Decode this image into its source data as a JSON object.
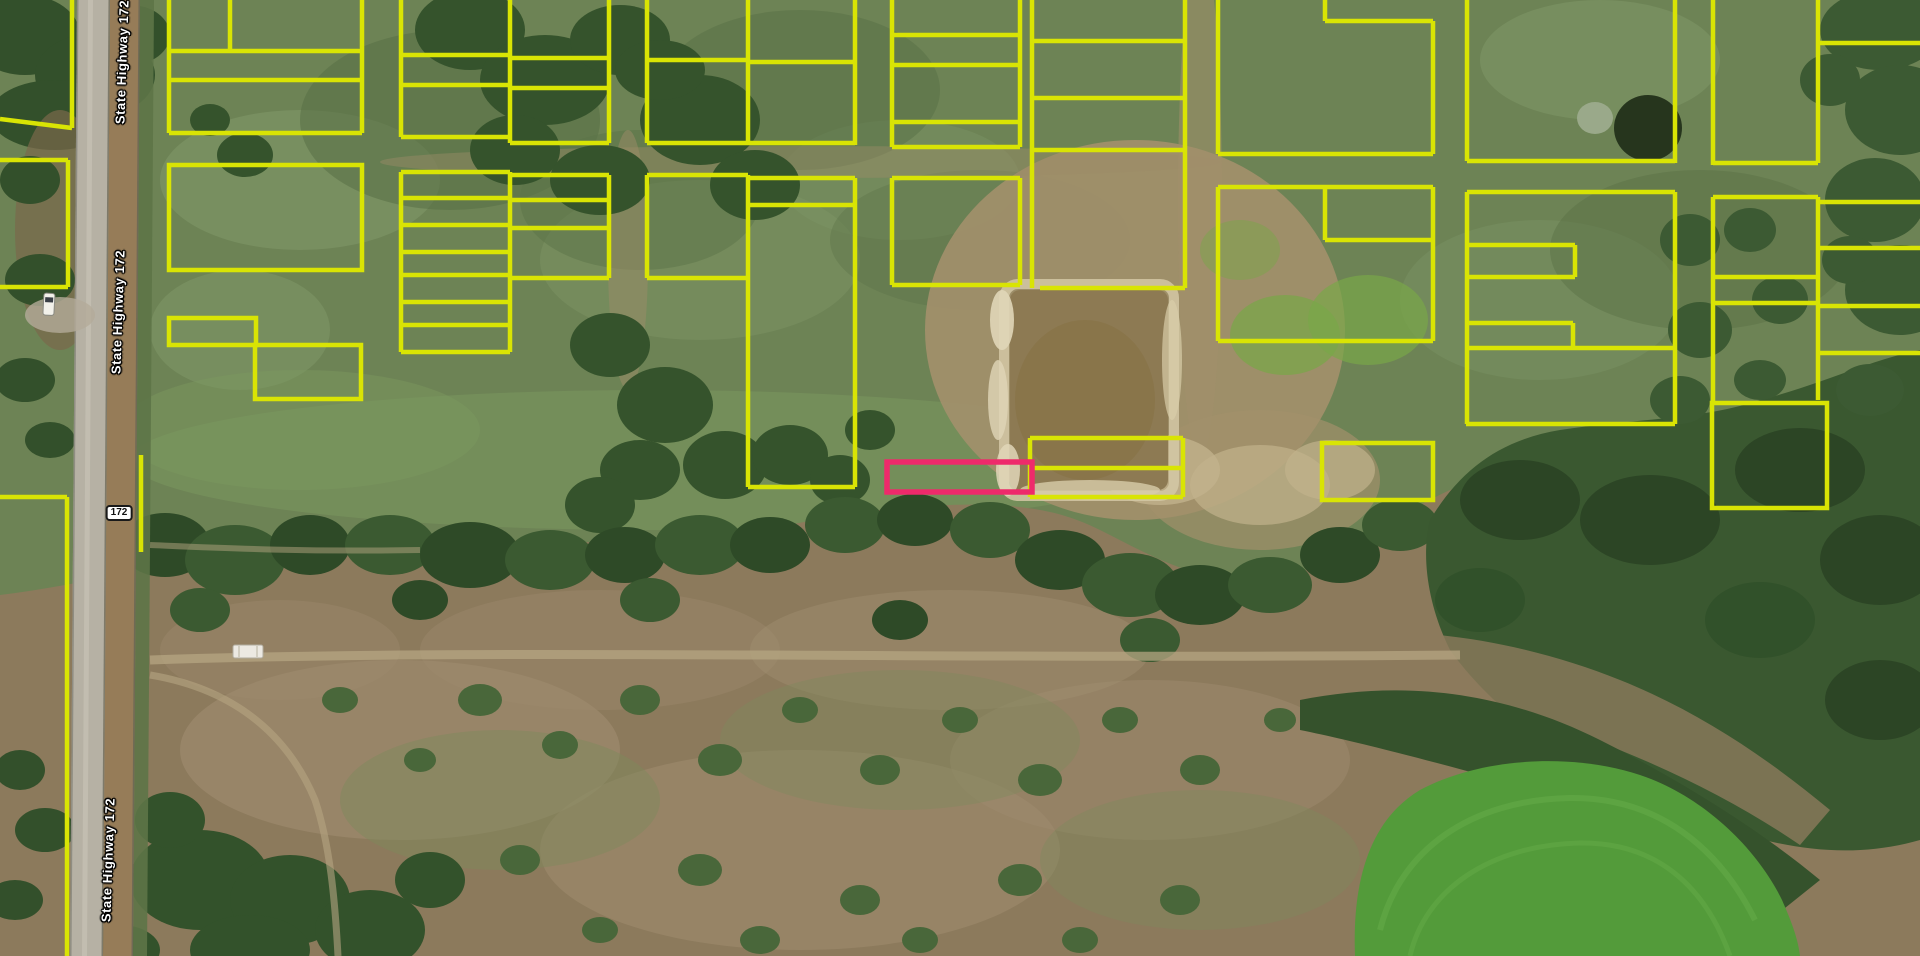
{
  "map": {
    "view": "aerial-imagery-with-parcel-overlay",
    "colors": {
      "parcel_line": "#d9e404",
      "selected_parcel": "#ee2a6b",
      "label_text": "#ffffff",
      "label_outline": "#000000",
      "shield_bg": "#ffffff",
      "shield_border": "#1a1a1a"
    },
    "road_labels": [
      {
        "text": "State Highway 172",
        "x": 122,
        "y": 62,
        "rotation": -88
      },
      {
        "text": "State Highway 172",
        "x": 118,
        "y": 312,
        "rotation": -88
      },
      {
        "text": "State Highway 172",
        "x": 108,
        "y": 860,
        "rotation": -88
      }
    ],
    "shield": {
      "text": "172",
      "x": 119,
      "y": 513
    },
    "selected_parcel": {
      "x": 887,
      "y": 462,
      "w": 145,
      "h": 30
    },
    "parcel_rects": [
      [
        169,
        165,
        193,
        105
      ],
      [
        169,
        318,
        87,
        27
      ],
      [
        255,
        345,
        106,
        54
      ],
      [
        1712,
        403,
        115,
        105
      ],
      [
        1322,
        443,
        111,
        57
      ]
    ],
    "parcel_segments": [
      [
        72,
        0,
        72,
        128
      ],
      [
        72,
        128,
        0,
        119
      ],
      [
        0,
        160,
        68,
        160
      ],
      [
        68,
        160,
        68,
        287
      ],
      [
        68,
        287,
        0,
        287
      ],
      [
        0,
        497,
        67,
        497
      ],
      [
        67,
        497,
        67,
        956
      ],
      [
        169,
        0,
        169,
        133
      ],
      [
        362,
        0,
        362,
        133
      ],
      [
        169,
        51,
        362,
        51
      ],
      [
        169,
        80,
        362,
        80
      ],
      [
        169,
        133,
        362,
        133
      ],
      [
        230,
        0,
        230,
        51
      ],
      [
        141,
        455,
        141,
        552
      ],
      [
        401,
        0,
        401,
        137
      ],
      [
        510,
        0,
        510,
        143
      ],
      [
        609,
        0,
        609,
        143
      ],
      [
        401,
        55,
        510,
        55
      ],
      [
        510,
        58,
        609,
        58
      ],
      [
        401,
        85,
        510,
        85
      ],
      [
        510,
        88,
        609,
        88
      ],
      [
        401,
        137,
        510,
        137
      ],
      [
        510,
        143,
        609,
        143
      ],
      [
        401,
        172,
        401,
        352
      ],
      [
        510,
        172,
        510,
        352
      ],
      [
        609,
        175,
        609,
        278
      ],
      [
        401,
        172,
        510,
        172
      ],
      [
        510,
        175,
        609,
        175
      ],
      [
        401,
        198,
        510,
        198
      ],
      [
        510,
        200,
        609,
        200
      ],
      [
        401,
        225,
        510,
        225
      ],
      [
        510,
        228,
        609,
        228
      ],
      [
        401,
        252,
        510,
        252
      ],
      [
        401,
        275,
        510,
        275
      ],
      [
        510,
        278,
        609,
        278
      ],
      [
        401,
        302,
        510,
        302
      ],
      [
        401,
        325,
        510,
        325
      ],
      [
        401,
        352,
        510,
        352
      ],
      [
        647,
        0,
        647,
        143
      ],
      [
        748,
        0,
        748,
        143
      ],
      [
        855,
        0,
        855,
        145
      ],
      [
        647,
        60,
        748,
        60
      ],
      [
        748,
        62,
        855,
        62
      ],
      [
        647,
        143,
        855,
        143
      ],
      [
        647,
        175,
        647,
        278
      ],
      [
        748,
        175,
        748,
        487
      ],
      [
        855,
        178,
        855,
        487
      ],
      [
        647,
        175,
        748,
        175
      ],
      [
        748,
        178,
        855,
        178
      ],
      [
        748,
        205,
        855,
        205
      ],
      [
        647,
        278,
        748,
        278
      ],
      [
        748,
        487,
        855,
        487
      ],
      [
        892,
        0,
        892,
        147
      ],
      [
        1020,
        0,
        1020,
        147
      ],
      [
        892,
        35,
        1020,
        35
      ],
      [
        892,
        65,
        1020,
        65
      ],
      [
        892,
        122,
        1020,
        122
      ],
      [
        892,
        147,
        1020,
        147
      ],
      [
        892,
        178,
        892,
        285
      ],
      [
        1020,
        178,
        1020,
        285
      ],
      [
        892,
        178,
        1020,
        178
      ],
      [
        892,
        285,
        1020,
        285
      ],
      [
        1032,
        0,
        1032,
        288
      ],
      [
        1185,
        0,
        1185,
        288
      ],
      [
        1032,
        41,
        1185,
        41
      ],
      [
        1032,
        98,
        1185,
        98
      ],
      [
        1032,
        150,
        1185,
        150
      ],
      [
        1040,
        288,
        1185,
        288
      ],
      [
        1030,
        438,
        1030,
        497
      ],
      [
        1183,
        438,
        1183,
        497
      ],
      [
        1030,
        438,
        1183,
        438
      ],
      [
        1030,
        468,
        1183,
        468
      ],
      [
        1030,
        497,
        1183,
        497
      ],
      [
        1218,
        0,
        1218,
        154
      ],
      [
        1325,
        0,
        1325,
        21
      ],
      [
        1325,
        21,
        1433,
        21
      ],
      [
        1433,
        21,
        1433,
        154
      ],
      [
        1218,
        154,
        1433,
        154
      ],
      [
        1218,
        187,
        1433,
        187
      ],
      [
        1218,
        187,
        1218,
        341
      ],
      [
        1433,
        187,
        1433,
        341
      ],
      [
        1325,
        187,
        1325,
        240
      ],
      [
        1325,
        240,
        1433,
        240
      ],
      [
        1218,
        341,
        1433,
        341
      ],
      [
        1467,
        0,
        1467,
        161
      ],
      [
        1675,
        0,
        1675,
        163
      ],
      [
        1467,
        161,
        1675,
        161
      ],
      [
        1467,
        192,
        1675,
        192
      ],
      [
        1467,
        192,
        1467,
        424
      ],
      [
        1675,
        192,
        1675,
        424
      ],
      [
        1466,
        424,
        1675,
        424
      ],
      [
        1467,
        245,
        1575,
        245
      ],
      [
        1575,
        245,
        1575,
        277
      ],
      [
        1467,
        277,
        1575,
        277
      ],
      [
        1467,
        323,
        1573,
        323
      ],
      [
        1573,
        323,
        1573,
        348
      ],
      [
        1467,
        348,
        1675,
        348
      ],
      [
        1713,
        0,
        1713,
        165
      ],
      [
        1818,
        0,
        1818,
        163
      ],
      [
        1713,
        163,
        1818,
        163
      ],
      [
        1818,
        43,
        1920,
        43
      ],
      [
        1713,
        197,
        1818,
        197
      ],
      [
        1713,
        197,
        1713,
        402
      ],
      [
        1818,
        197,
        1818,
        400
      ],
      [
        1713,
        277,
        1818,
        277
      ],
      [
        1713,
        303,
        1818,
        303
      ],
      [
        1818,
        202,
        1920,
        202
      ],
      [
        1818,
        248,
        1920,
        248
      ],
      [
        1818,
        306,
        1920,
        306
      ],
      [
        1818,
        353,
        1920,
        353
      ]
    ]
  }
}
